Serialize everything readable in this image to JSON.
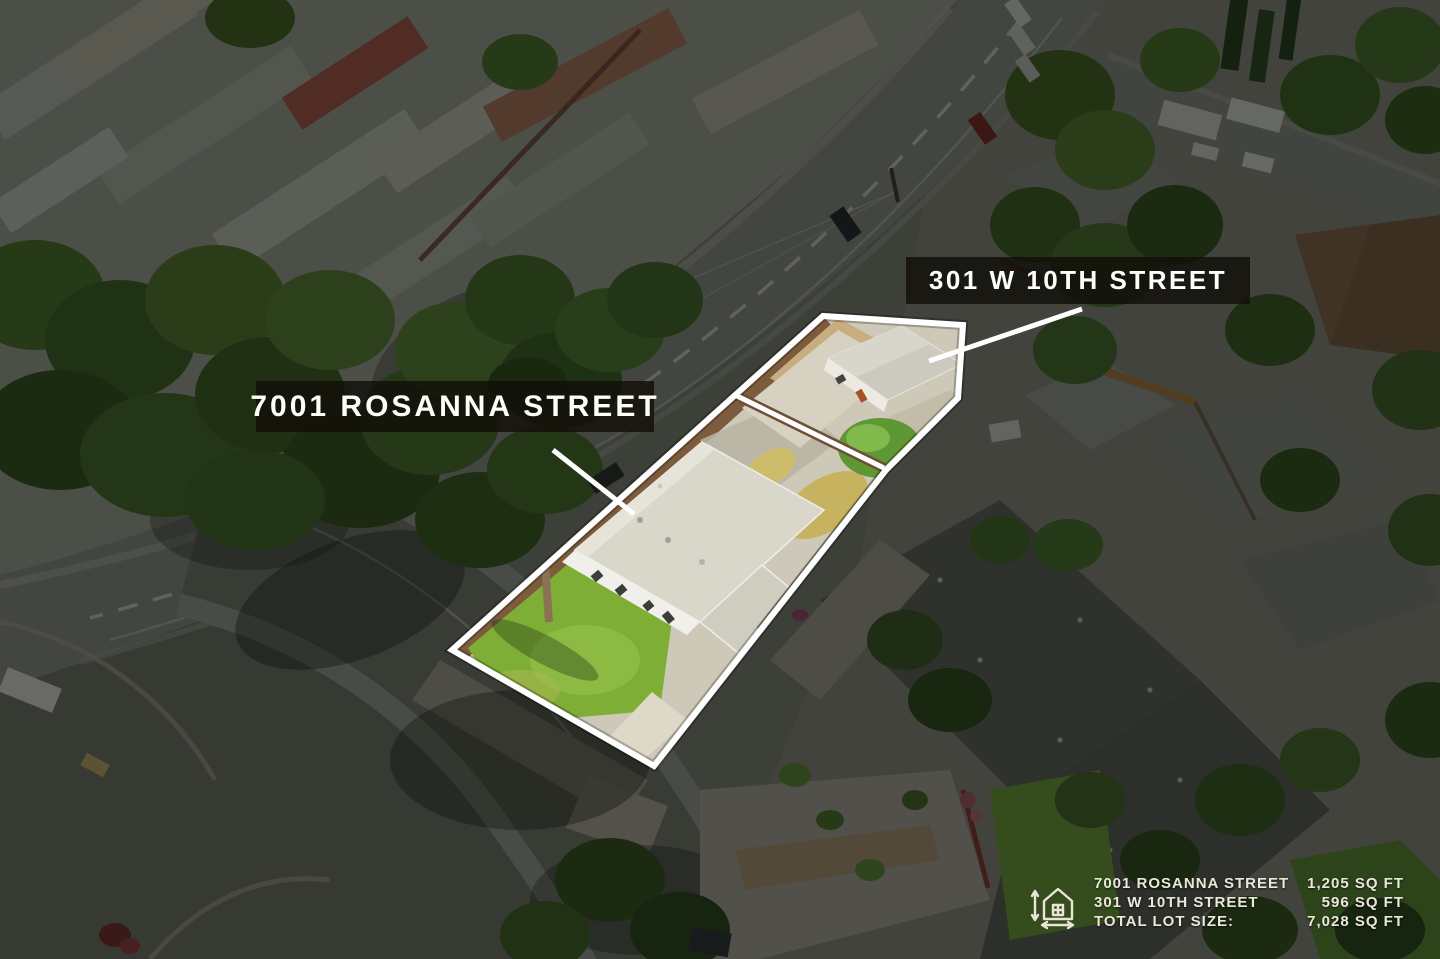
{
  "labels": {
    "rosanna": {
      "text": "7001 ROSANNA STREET"
    },
    "tenth": {
      "text": "301 W 10TH STREET"
    }
  },
  "legend": {
    "icon": "house-dimensions-icon",
    "rows": [
      {
        "label": "7001 ROSANNA STREET",
        "value": "1,205 SQ FT"
      },
      {
        "label": "301 W 10TH STREET",
        "value": "596 SQ FT"
      },
      {
        "label": "TOTAL LOT SIZE:",
        "value": "7,028 SQ FT"
      }
    ]
  },
  "colors": {
    "outline": "#ffffff",
    "callout": "#ffffff",
    "label_bg": "rgba(18,15,9,0.82)",
    "label_text": "#fdfdfa",
    "legend_text": "#ebe7da"
  }
}
